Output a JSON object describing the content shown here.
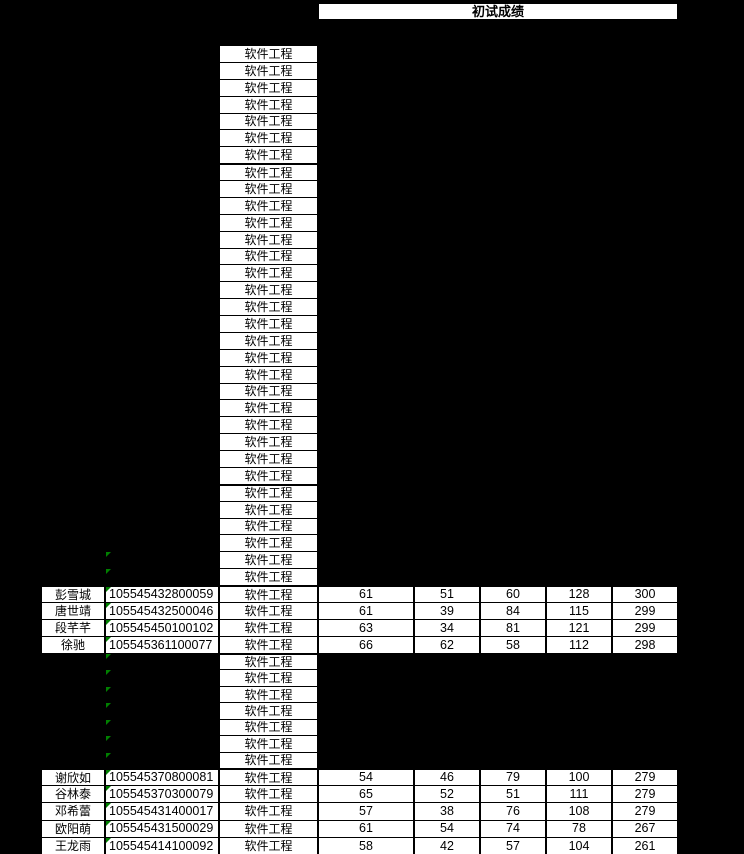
{
  "header": {
    "title": "初试成绩"
  },
  "major_label": "软件工程",
  "colors": {
    "background": "#000000",
    "cell_fill": "#FFFFFF",
    "grid_line": "#000000",
    "text": "#000000",
    "error_triangle_green": "#008000"
  },
  "icons": {
    "error_indicator": "error-indicator-triangle-icon"
  },
  "sections": [
    {
      "kind": "majors",
      "count": 7,
      "thick_top": false,
      "triangles": false
    },
    {
      "kind": "majors",
      "count": 19,
      "thick_top": true,
      "triangles": false
    },
    {
      "kind": "majors",
      "count": 4,
      "thick_top": true,
      "triangles": false
    },
    {
      "kind": "majors",
      "count": 2,
      "thick_top": false,
      "triangles": true
    },
    {
      "kind": "records",
      "thick_top": true,
      "records": [
        {
          "name": "彭雪城",
          "id": "105545432800059",
          "scores": [
            61,
            51,
            60,
            128,
            300
          ]
        },
        {
          "name": "唐世靖",
          "id": "105545432500046",
          "scores": [
            61,
            39,
            84,
            115,
            299
          ]
        },
        {
          "name": "段芊芊",
          "id": "105545450100102",
          "scores": [
            63,
            34,
            81,
            121,
            299
          ]
        },
        {
          "name": "徐驰",
          "id": "105545361100077",
          "scores": [
            66,
            62,
            58,
            112,
            298
          ]
        }
      ]
    },
    {
      "kind": "majors",
      "count": 7,
      "thick_top": true,
      "triangles": true
    },
    {
      "kind": "records",
      "thick_top": true,
      "records": [
        {
          "name": "谢欣如",
          "id": "105545370800081",
          "scores": [
            54,
            46,
            79,
            100,
            279
          ]
        },
        {
          "name": "谷林泰",
          "id": "105545370300079",
          "scores": [
            65,
            52,
            51,
            111,
            279
          ]
        },
        {
          "name": "邓希蕾",
          "id": "105545431400017",
          "scores": [
            57,
            38,
            76,
            108,
            279
          ]
        },
        {
          "name": "欧阳萌",
          "id": "105545431500029",
          "scores": [
            61,
            54,
            74,
            78,
            267
          ]
        },
        {
          "name": "王龙雨",
          "id": "105545414100092",
          "scores": [
            58,
            42,
            57,
            104,
            261
          ]
        }
      ]
    }
  ]
}
